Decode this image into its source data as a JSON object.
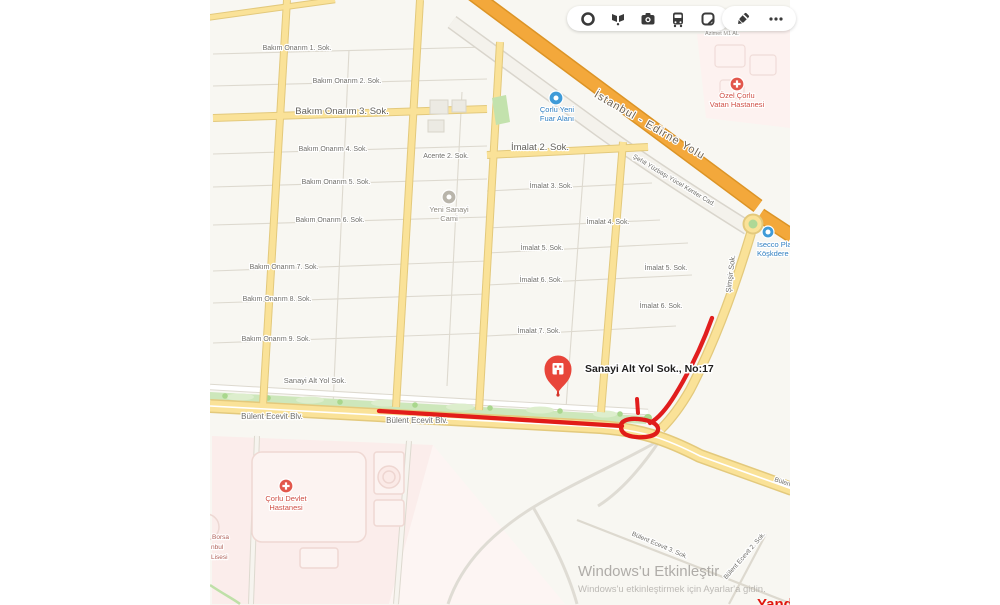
{
  "app": {
    "logo": "Yandex",
    "watermark_line1": "Windows'u Etkinleştir",
    "watermark_line2": "Windows'u etkinleştirmek için Ayarlar'a gidin."
  },
  "toolbar": {
    "icons": [
      {
        "name": "traffic-icon"
      },
      {
        "name": "panoramas-icon"
      },
      {
        "name": "photos-icon"
      },
      {
        "name": "transport-icon"
      },
      {
        "name": "bookmark-icon"
      },
      {
        "name": "pencil-icon"
      },
      {
        "name": "more-icon"
      }
    ]
  },
  "map": {
    "marker": {
      "label": "Sanayi Alt Yol Sok., No:17"
    },
    "colors": {
      "route": "#e01212",
      "road_yellow": "#fae298",
      "road_casing": "#e3c97c",
      "highway": "#f3a83b",
      "highway_casing": "#dc9426",
      "green": "#cde7bb",
      "pink": "#fbedeb",
      "marker_red": "#e8453a",
      "poi_red": "#e2574c",
      "poi_blue": "#3f9bd8",
      "poi_gray": "#b9b5ab",
      "label_gray": "#6f6e69"
    },
    "street_labels": [
      {
        "text": "Bakım Onarım 1. Sok.",
        "x": 297,
        "y": 50
      },
      {
        "text": "Bakım Onarım 2. Sok.",
        "x": 347,
        "y": 83
      },
      {
        "text": "Bakım Onarım 3. Sok.",
        "x": 342,
        "y": 114,
        "size": 9.5,
        "color": "#63615b"
      },
      {
        "text": "Bakım Onarım 4. Sok.",
        "x": 333,
        "y": 151
      },
      {
        "text": "Bakım Onarım 5. Sok.",
        "x": 336,
        "y": 184
      },
      {
        "text": "Bakım Onarım 6. Sok.",
        "x": 330,
        "y": 222
      },
      {
        "text": "Bakım Onarım 7. Sok.",
        "x": 284,
        "y": 269
      },
      {
        "text": "Bakım Onarım 8. Sok.",
        "x": 277,
        "y": 301
      },
      {
        "text": "Bakım Onarım 9. Sok.",
        "x": 276,
        "y": 341
      },
      {
        "text": "Acente 2. Sok.",
        "x": 446,
        "y": 158
      },
      {
        "text": "İmalat 2. Sok.",
        "x": 540,
        "y": 150,
        "size": 9.5,
        "color": "#63615b"
      },
      {
        "text": "İmalat 3. Sok.",
        "x": 551,
        "y": 188
      },
      {
        "text": "İmalat 4. Sok.",
        "x": 608,
        "y": 224
      },
      {
        "text": "İmalat 5. Sok.",
        "x": 542,
        "y": 250
      },
      {
        "text": "İmalat 6. Sok.",
        "x": 541,
        "y": 282
      },
      {
        "text": "İmalat 7. Sok.",
        "x": 539,
        "y": 333
      },
      {
        "text": "İmalat 5. Sok.",
        "x": 666,
        "y": 270
      },
      {
        "text": "İmalat 6. Sok.",
        "x": 661,
        "y": 308
      },
      {
        "text": "Sanayi Alt Yol Sok.",
        "x": 315,
        "y": 383,
        "size": 7.5
      },
      {
        "text": "Bülent Ecevit Blv.",
        "x": 272,
        "y": 419,
        "size": 8
      },
      {
        "text": "Bülent Ecevit Blv.",
        "x": 417,
        "y": 423,
        "size": 8
      },
      {
        "text": "Şimşir Sok.",
        "x": 733,
        "y": 274,
        "size": 7.5,
        "rot": -83
      },
      {
        "text": "İstanbul - Edirne Yolu",
        "x": 648,
        "y": 128,
        "size": 11,
        "rot": 30,
        "color": "#6e6353",
        "weight": 500,
        "ls": 1
      },
      {
        "text": "Şehit Yüzbaşı Yücel Kenter Cad.",
        "x": 673,
        "y": 182,
        "size": 6.5,
        "rot": 31
      },
      {
        "text": "Bülent Ecevit 3. Sok.",
        "x": 659,
        "y": 547,
        "size": 6.5,
        "rot": 23
      },
      {
        "text": "Bülent Ecevit 2. Sok.",
        "x": 746,
        "y": 557,
        "size": 6.5,
        "rot": -49
      },
      {
        "text": "Bülent Ecevit Blv.",
        "x": 774,
        "y": 481,
        "size": 6.5,
        "rot": 19,
        "anchor": "start"
      },
      {
        "text": "Azimet M1 AL",
        "x": 722,
        "y": 35,
        "size": 5.5,
        "color": "#94908a"
      },
      {
        "text": "Borsa",
        "x": 212,
        "y": 539,
        "size": 6.5,
        "color": "#b06058",
        "anchor": "start"
      },
      {
        "text": "nbul",
        "x": 211,
        "y": 549,
        "size": 6.5,
        "color": "#b06058",
        "anchor": "start"
      },
      {
        "text": "Lisesi",
        "x": 211,
        "y": 559,
        "size": 6.5,
        "color": "#b06058",
        "anchor": "start"
      }
    ],
    "pois": [
      {
        "name": "corlu-yeni-fuar-alani",
        "lines": [
          "Çorlu Yeni",
          "Fuar Alanı"
        ],
        "x": 557,
        "y": 112,
        "icon": "expo",
        "ix": 556,
        "iy": 98,
        "color": "#2f7fc1"
      },
      {
        "name": "yeni-sanayi-cami",
        "lines": [
          "Yeni Sanayi",
          "Cami"
        ],
        "x": 449,
        "y": 212,
        "icon": "mosque",
        "ix": 449,
        "iy": 197,
        "color": "#8d897f"
      },
      {
        "name": "ozel-corlu-vatan-hastanesi",
        "lines": [
          "Özel Çorlu",
          "Vatan Hastanesi"
        ],
        "x": 737,
        "y": 98,
        "icon": "hospital",
        "ix": 737,
        "iy": 84,
        "color": "#cf4e44"
      },
      {
        "name": "corlu-devlet-hastanesi",
        "lines": [
          "Çorlu Devlet",
          "Hastanesi"
        ],
        "x": 286,
        "y": 501,
        "icon": "hospital",
        "ix": 286,
        "iy": 486,
        "color": "#cf4e44"
      },
      {
        "name": "isecco-plaza",
        "lines": [
          "Isecco Plaz",
          "Köşkdere"
        ],
        "x": 757,
        "y": 247,
        "icon": "office",
        "ix": 768,
        "iy": 232,
        "color": "#2f7fc1",
        "anchor": "start"
      }
    ]
  }
}
